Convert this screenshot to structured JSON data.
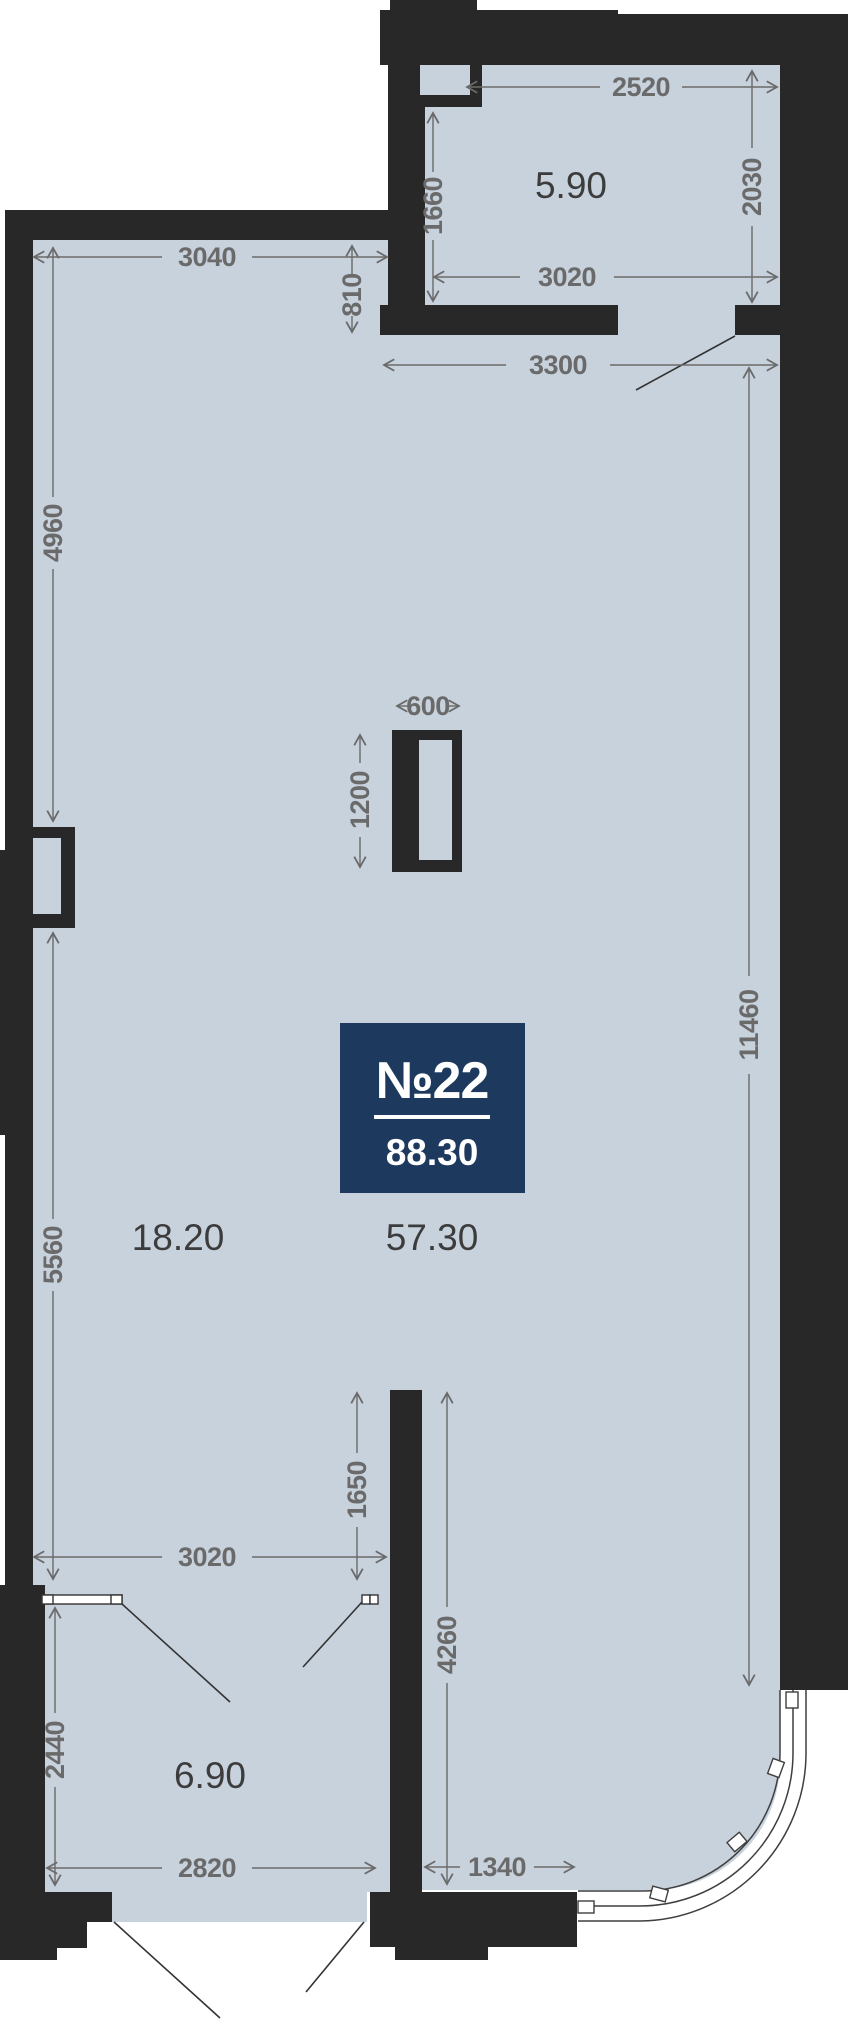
{
  "plan": {
    "badge": {
      "number": "№22",
      "total_area": "88.30"
    },
    "areas": {
      "room_top": "5.90",
      "room_left": "18.20",
      "room_main": "57.30",
      "room_bottom": "6.90"
    },
    "dims": {
      "top_width": "2520",
      "top_height": "2030",
      "top_left_height": "1660",
      "top_room_width": "3020",
      "main_top_width": "3040",
      "top_offset": "810",
      "opening_width": "3300",
      "left_upper_height": "4960",
      "shaft_width": "600",
      "shaft_height": "1200",
      "right_height": "11460",
      "left_lower_height": "5560",
      "partition_upper": "1650",
      "bottom_opening": "3020",
      "partition_height": "4260",
      "bottom_left_height": "2440",
      "bottom_room_width": "2820",
      "bottom_right_width": "1340"
    }
  },
  "colors": {
    "floor": "#c8d2dd",
    "wall": "#282828",
    "dimension": "#6a6a6a",
    "area_text": "#3c3c3c",
    "badge_bg": "#1d3a5e",
    "badge_text": "#ffffff",
    "background": "#ffffff"
  }
}
